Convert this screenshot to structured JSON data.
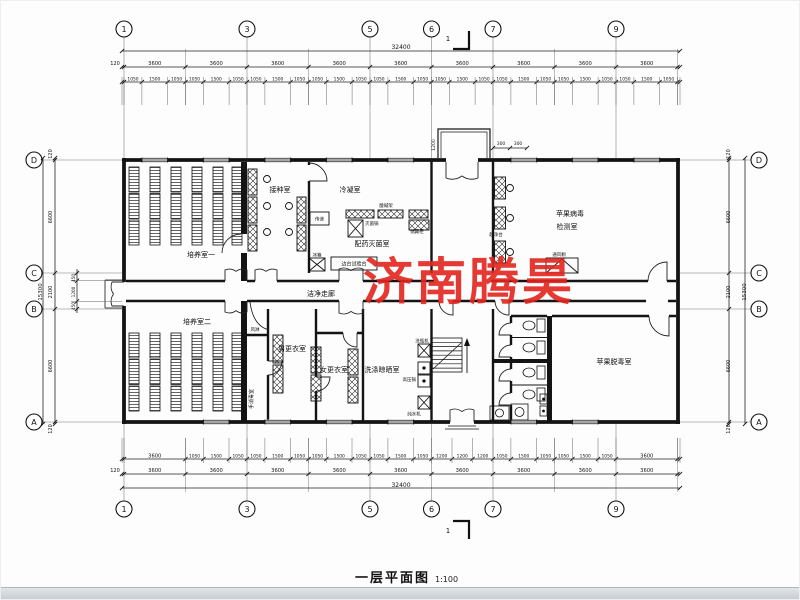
{
  "title": {
    "text": "一层平面图",
    "scale": "1:100"
  },
  "watermark": {
    "text": "济南腾昊",
    "color": "#e3261e"
  },
  "section": {
    "label": "1"
  },
  "grid": {
    "cols": [
      "1",
      "3",
      "5",
      "6",
      "7",
      "9"
    ],
    "rows": [
      "D",
      "C",
      "B",
      "A"
    ]
  },
  "dims": {
    "total_h": "32400",
    "total_v": "15300",
    "bay": "3600",
    "edge": "120",
    "sub_a": "1050",
    "sub_b": "1500",
    "sub_c": "1200",
    "six": "6600",
    "mid": "2100",
    "c450": "450",
    "p300": "300"
  },
  "rooms": {
    "culture1": "培养室一",
    "culture2": "培养室二",
    "inoculation": "接种室",
    "condensation": "冷凝室",
    "prep": "配药灭菌室",
    "corridor": "洁净走廊",
    "test1": "苹果病毒",
    "test2": "检测室",
    "detox": "苹果脱毒室",
    "men": "男更衣室",
    "women": "女更衣室",
    "wash": "洗涤晾晒室",
    "hand": "手消毒室",
    "airshower": "风淋"
  },
  "equipment": {
    "clean_bench": "超净台",
    "fume_hood": "通风橱",
    "acid_rack": "酸碱架",
    "sterilizer": "灭菌锅",
    "storage": "储藏柜",
    "side_bench": "边台试验台",
    "pass": "传递",
    "fridge": "冰箱",
    "bottle_washer": "洗瓶机",
    "autoclave": "高压锅",
    "water_purifier": "纯水机"
  }
}
